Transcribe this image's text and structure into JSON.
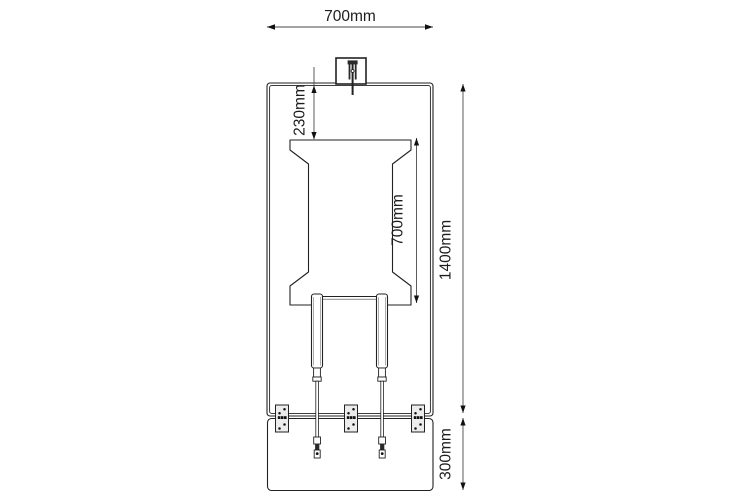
{
  "drawing": {
    "type": "technical-dimension-drawing",
    "background_color": "#ffffff",
    "line_color": "#222222",
    "dim_line_color": "#4a4a4a",
    "plate_fill_color": "#ececec",
    "labels": {
      "overall_width": "700mm",
      "top_offset": "230mm",
      "girder_height": "700mm",
      "overall_height": "1400mm",
      "base_height": "300mm"
    },
    "parts": [
      "mount-box",
      "main-frame",
      "girder-profile",
      "damper-left",
      "damper-right",
      "anchor-plate-left",
      "anchor-plate-center",
      "anchor-plate-right",
      "base-plate"
    ]
  }
}
